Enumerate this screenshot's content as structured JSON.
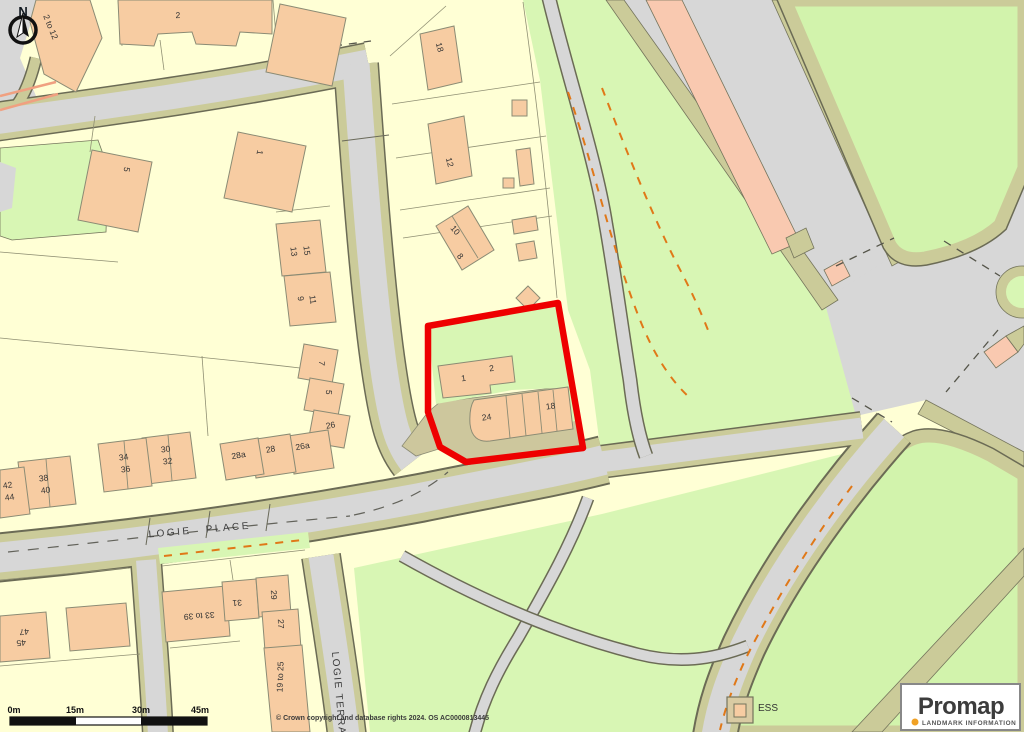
{
  "map": {
    "street_labels": {
      "logie_place": "LOGIE PLACE",
      "logie_terrace": "LOGIE TERRACE"
    },
    "area_labels": {
      "ess": "ESS"
    },
    "building_labels": {
      "b2to12": "2 to 12",
      "t2": "2",
      "t5": "5",
      "t1": "1",
      "b13": "13",
      "b15": "15",
      "b9": "9",
      "b11": "11",
      "b7": "7",
      "m5": "5",
      "b26": "26",
      "b26a": "26a",
      "b28": "28",
      "b28a": "28a",
      "b30": "30",
      "b32": "32",
      "b34": "34",
      "b36": "36",
      "b38": "38",
      "b40": "40",
      "b42": "42",
      "b44": "44",
      "b45": "45",
      "b47": "47",
      "b33to39": "33 to 39",
      "b31": "31",
      "b29": "29",
      "b27": "27",
      "b19to25": "19 to 25",
      "c18": "18",
      "c12": "12",
      "c10": "10",
      "c8": "8"
    },
    "plot_labels": {
      "u1": "1",
      "u2": "2",
      "u24": "24",
      "u18": "18"
    },
    "colors": {
      "plot_boundary": "#EE0000",
      "buildings": "#F7CCA2",
      "greenspace": "#D8F6B4",
      "road": "#D7D7D7",
      "verge": "#CBCB99",
      "parcel_cream": "#FFFFD5",
      "path_marking": "#E07818",
      "logo_accent": "#F0A125"
    }
  },
  "compass": {
    "north_label": "N"
  },
  "scale_bar": {
    "tick_labels": [
      "0m",
      "15m",
      "30m",
      "45m"
    ]
  },
  "attribution": {
    "copyright": "© Crown copyright and database rights 2024. OS AC0000813445"
  },
  "logo": {
    "brand": "Promap",
    "subtitle": "LANDMARK INFORMATION"
  }
}
